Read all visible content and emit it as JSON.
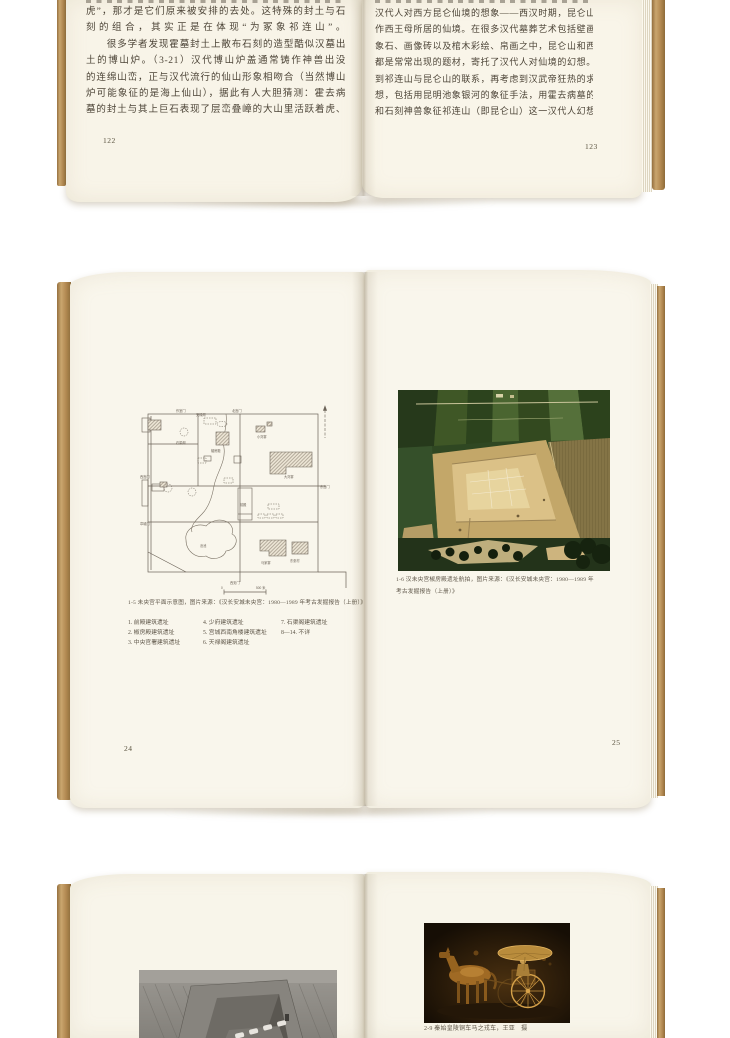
{
  "colors": {
    "background": "#ffffff",
    "page_cream": "#f8f4e8",
    "cover_edge_tan": "#b68c55",
    "body_text": "#4c4437",
    "aerial_green": "#2f4722",
    "aerial_tan": "#c3a769",
    "chariot_gold": "#c08a3a"
  },
  "spread_top": {
    "left_page": {
      "page_number": "122",
      "lines": [
        "虎”，那才是它们原来被安排的去处。这特殊的封土与石",
        "刻的组合，其实正是在体现“为冢象祁连山”。",
        "　　很多学者发现霍墓封土上散布石刻的造型酷似汉墓出",
        "土的博山炉。（3-21）汉代博山炉盖通常铸作神兽出没",
        "的连绵山峦，正与汉代流行的仙山形象相吻合（当然博山",
        "炉可能象征的是海上仙山），据此有人大胆猜测：霍去病",
        "墓的封土与其上巨石表现了层峦叠嶂的大山里活跃着虎、"
      ]
    },
    "right_page": {
      "page_number": "123",
      "lines": [
        "汉代人对西方昆仑仙境的想象——西汉时期，昆仑山被看",
        "作西王母所居的仙境。在很多汉代墓葬艺术包括壁画、画",
        "象石、画像砖以及棺木彩绘、帛画之中，昆仑山和西王母",
        "都是常常出现的题材，寄托了汉代人对仙境的幻想。考虑",
        "到祁连山与昆仑山的联系，再考虑到汉武帝狂热的求仙思",
        "想，包括用昆明池象银河的象征手法，用霍去病墓的冢山",
        "和石刻神兽象征祁连山（即昆仑山）这一汉代人幻想中的"
      ]
    }
  },
  "spread_middle": {
    "left_page": {
      "page_number": "24",
      "figure_caption": "1-5 未央宫平面示意图，图片来源：《汉长安城未央宫：1980—1989 年考古发掘报告（上册）》",
      "legend_col1": [
        "1. 前殿建筑遗址",
        "2. 椒房殿建筑遗址",
        "3. 中央官署建筑遗址"
      ],
      "legend_col2": [
        "4. 少府建筑遗址",
        "5. 宫城西南角楼建筑遗址",
        "6. 天禄阁建筑遗址"
      ],
      "legend_col3": [
        "7. 石渠阁建筑遗址",
        "8—14. 不详"
      ],
      "plan": {
        "gates": [
          "作室门",
          "北宫门",
          "西宫门",
          "章城门",
          "东宫门",
          "西安门"
        ],
        "sites": [
          "石渠阁",
          "天禄阁",
          "椒房殿",
          "小刘寨",
          "大刘寨",
          "前殿",
          "沧池",
          "马家寨",
          "东张村"
        ],
        "scale_zero": "0",
        "scale_label": "500 米"
      }
    },
    "right_page": {
      "page_number": "25",
      "figure_caption_line1": "1-6 汉未央宫椒房殿遗址航拍，图片来源：《汉长安城未央宫：1980—1989 年",
      "figure_caption_line2": "考古发掘报告（上册）》"
    }
  },
  "spread_bottom": {
    "right_page": {
      "figure_caption": "2-9 秦始皇陵铜车马之戎车，王亚　摄"
    }
  }
}
